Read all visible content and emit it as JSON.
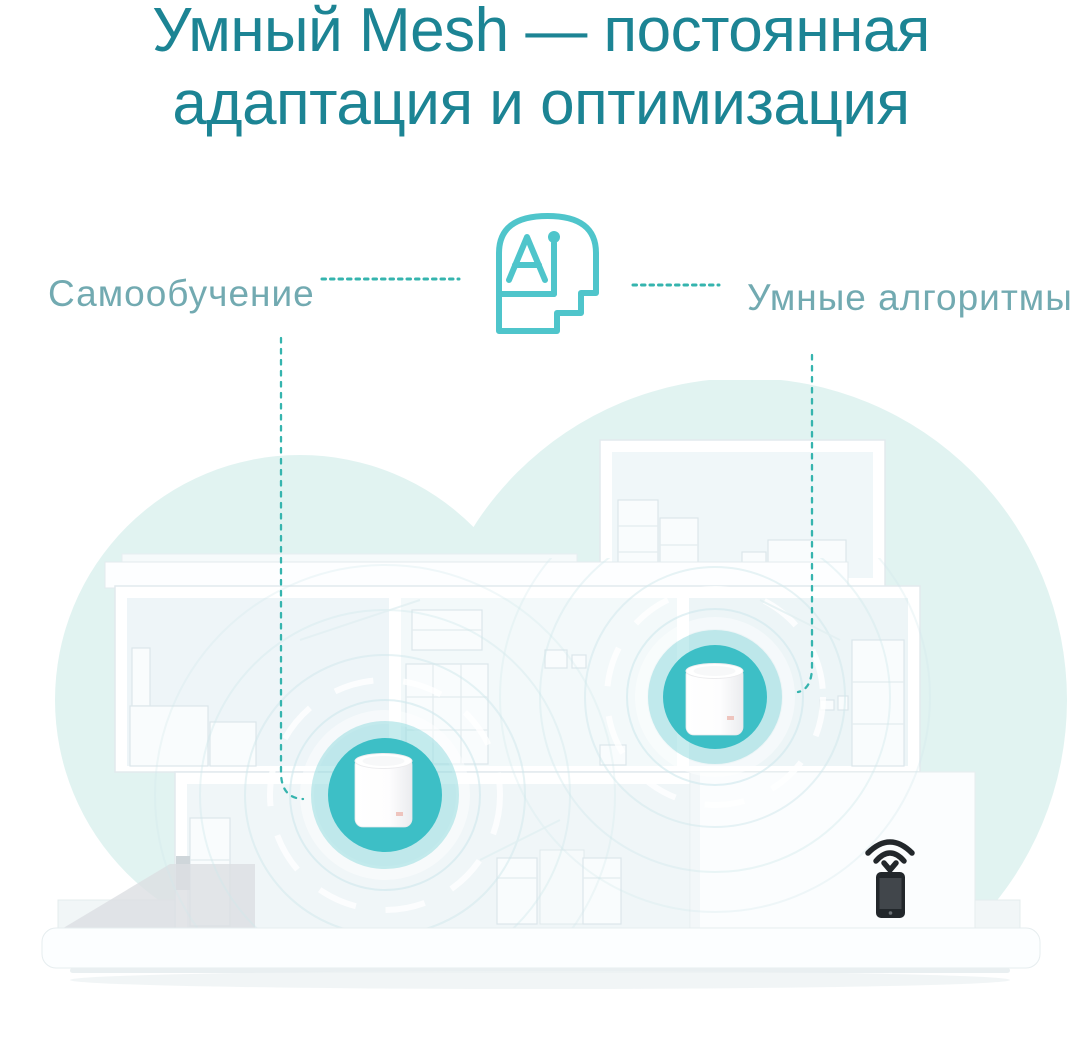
{
  "title": {
    "line1": "Умный Mesh — постоянная",
    "line2": "адаптация и оптимизация"
  },
  "callouts": {
    "left_label": "Самообучение",
    "right_label": "Умные алгоритмы"
  },
  "icons": {
    "center_icon": "ai-head-icon",
    "left_connector": "dotted-connector",
    "right_connector": "dotted-connector",
    "device_icon": "mesh-router-in-signal-circle",
    "client_icon": "smartphone-receiving-wifi-icon"
  },
  "colors": {
    "title_teal": "#1c8494",
    "label_teal": "#72aab1",
    "connector_teal": "#35b4ae",
    "ai_icon_teal": "#4fc5cb",
    "device_teal": "#3dbfc6",
    "device_halo": "#8edade",
    "cloud_mint": "#e1f3f1",
    "phone_dark": "#22272b"
  }
}
